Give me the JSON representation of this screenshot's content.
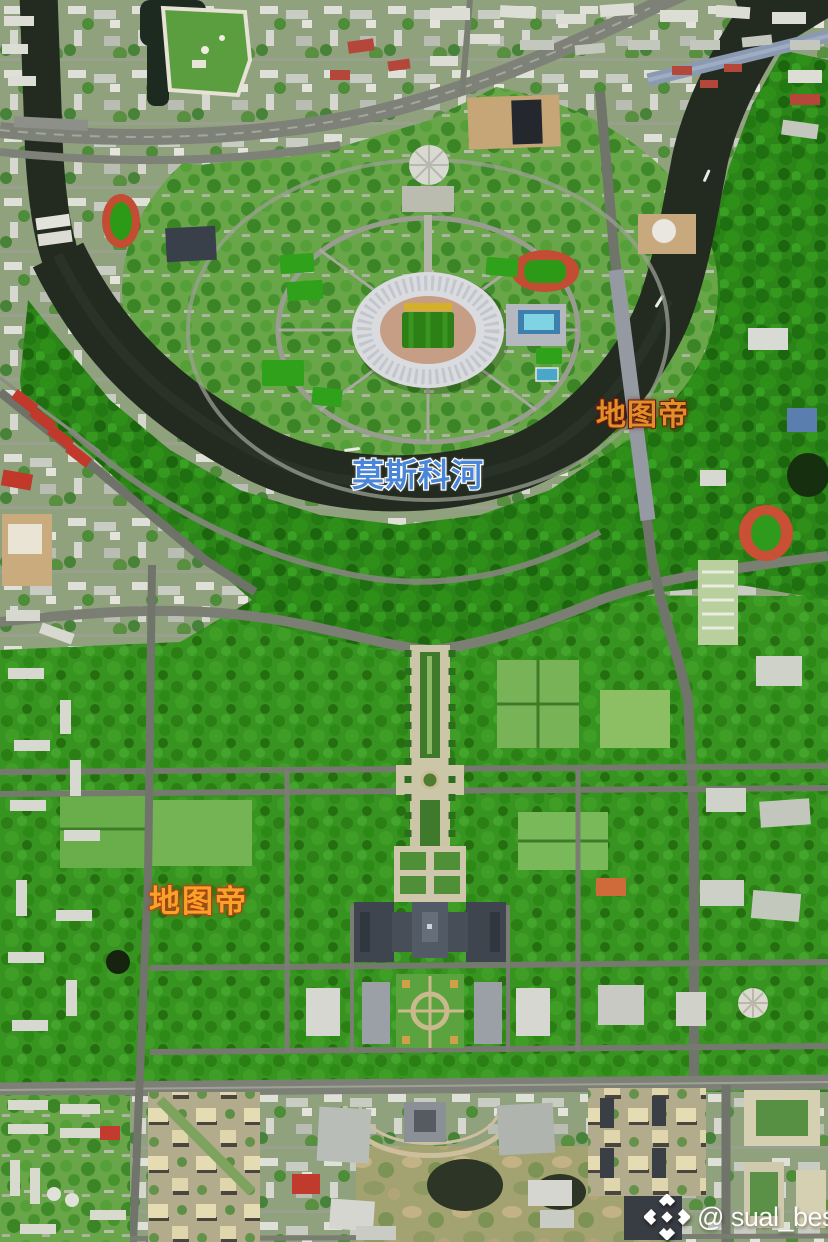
{
  "image_type": "satellite-photo-with-overlays",
  "labels": {
    "river": {
      "text": "莫斯科河",
      "fill": "#4a86d8",
      "outline": "#ffffff"
    },
    "brand_upper": {
      "text": "地图帝",
      "fill": "#e08f2a",
      "outline": "#7c200f"
    },
    "brand_lower": {
      "text": "地图帝",
      "fill": "#f6a32a",
      "outline": "#c2451c"
    },
    "credit": {
      "text": "@ sual_besta",
      "fill": "#ffffff"
    }
  },
  "icons": {
    "credit_logo": "diamond-chevrons-logo"
  },
  "palette": {
    "forest": "#2c8518",
    "campus_green": "#379421",
    "park": "#69a649",
    "river": "#232b20",
    "urban": "#90a17e",
    "road": "#7a7d72",
    "stadium_roof": "#d9dbdf",
    "stadium_pitch": "#2c8016",
    "track_red": "#c24d33",
    "bridge_blue": "#8b9ab3",
    "cream_housing": "#e0d6ae",
    "red_roof": "#c0392b"
  }
}
